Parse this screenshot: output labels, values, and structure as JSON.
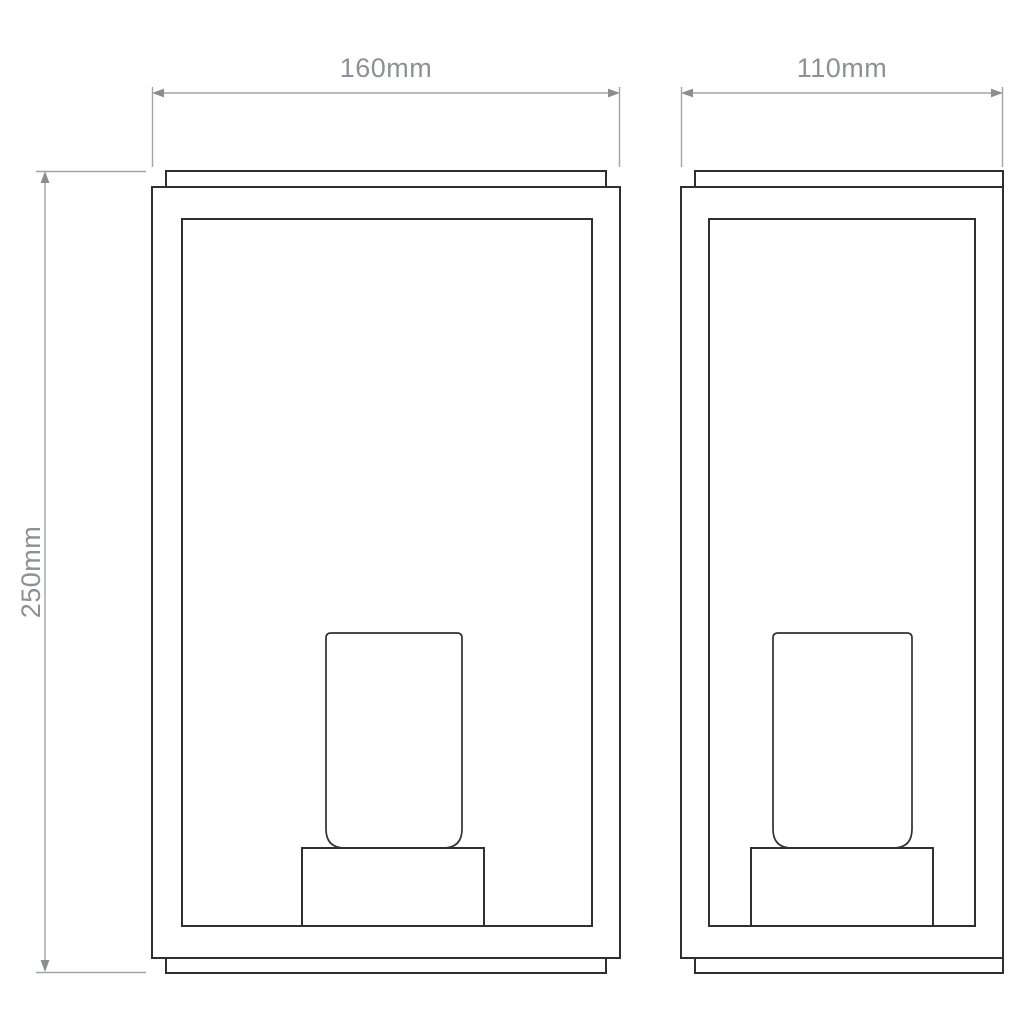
{
  "canvas": {
    "background": "#ffffff"
  },
  "drawing": {
    "outline_color": "#303030",
    "dimension_line_color": "#a2a4a6",
    "arrow_color": "#8b8d8f",
    "label_color": "#8e9093",
    "labels": {
      "front_width": "160mm",
      "side_width": "110mm",
      "height": "250mm"
    }
  }
}
